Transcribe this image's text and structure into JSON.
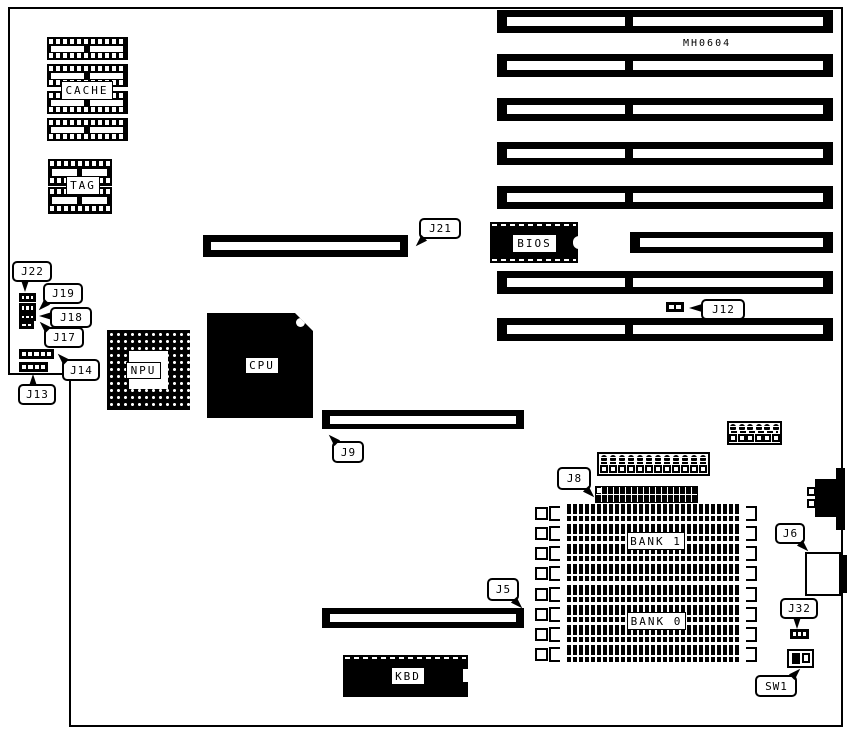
{
  "board": {
    "part_number": "MH0604",
    "labels": {
      "cache": "CACHE",
      "tag": "TAG",
      "npu": "NPU",
      "cpu": "CPU",
      "bios": "BIOS",
      "kbd": "KBD",
      "bank1": "BANK 1",
      "bank0": "BANK 0"
    },
    "callouts": {
      "j21": "J21",
      "j22": "J22",
      "j19": "J19",
      "j18": "J18",
      "j17": "J17",
      "j14": "J14",
      "j13": "J13",
      "j12": "J12",
      "j9": "J9",
      "j8": "J8",
      "j6": "J6",
      "j5": "J5",
      "j32": "J32",
      "sw1": "SW1"
    },
    "colors": {
      "ink": "#000000",
      "paper": "#ffffff"
    }
  }
}
